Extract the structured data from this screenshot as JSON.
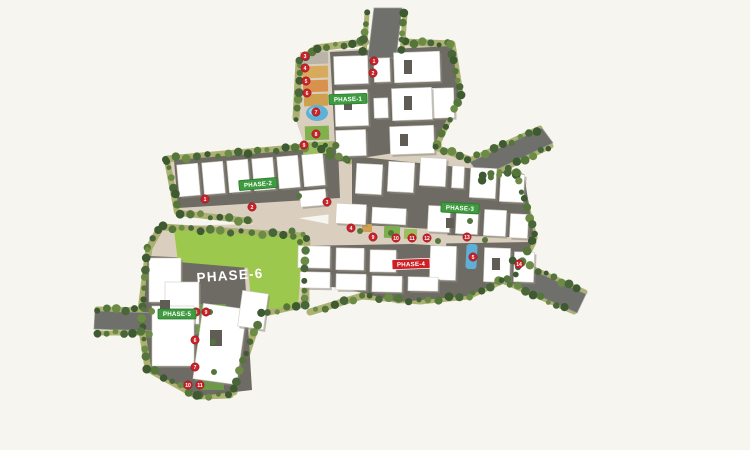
{
  "background": "#f7f5f0",
  "palette": {
    "ground": "#dacfbf",
    "pad": "#6e6b64",
    "road": "#6f6f6c",
    "road_edge": "#9b9b94",
    "verge": "#a9ae6c",
    "trees": [
      "#3d5a31",
      "#55763a",
      "#6c8c45",
      "#49663a"
    ],
    "building": "#ffffff",
    "building_shadow": "#8d897f",
    "building_stroke": "#cfcabf",
    "detail": "#5f5c55",
    "lawn_field": "#9cc84e",
    "pool": "#5fb0d8",
    "pool_light": "#9ad2e8",
    "marker": "#c8232b",
    "marker_stroke": "#8e1116",
    "marker_text": "#ffffff",
    "phase_green": "#3f9b3f",
    "phase_green_dark": "#2e7a2e",
    "phase_red": "#cf1f26",
    "label_text": "#ffffff"
  },
  "ground": [
    {
      "name": "phase1-ground",
      "pts": "300,52 452,44 461,96 434,150 352,168 314,172 295,118"
    },
    {
      "name": "phase2-ground",
      "pts": "166,158 344,142 348,212 284,220 268,248 252,222 178,212"
    },
    {
      "name": "center-ground",
      "pts": "268,212 348,228 344,256 264,244"
    },
    {
      "name": "phase3-ground",
      "pts": "338,148 432,144 478,160 522,172 536,240 522,274 468,298 398,304 344,288 328,232 330,176"
    },
    {
      "name": "phase56-ground",
      "pts": "158,226 262,224 268,210 292,208 300,226 308,226 310,302 262,316 232,396 196,398 150,372 140,318 148,246"
    }
  ],
  "pads": [
    {
      "name": "phase1-pad",
      "pts": "330,52 452,46 459,95 433,147 336,162"
    },
    {
      "name": "phase2-pad",
      "pts": "174,160 338,147 340,198 178,208"
    },
    {
      "name": "phase3-pad-upper",
      "pts": "352,156 524,174 534,238 352,232"
    },
    {
      "name": "phase3-pad-lower",
      "pts": "296,246 532,242 522,272 468,296 398,302 344,288 294,284"
    },
    {
      "name": "phase3-amenity-strip",
      "pts": "346,224 448,230 446,246 344,240",
      "fill": "#dacfbf"
    },
    {
      "name": "phase56-pad",
      "pts": "148,256 244,260 252,390 200,396 152,372 143,318"
    }
  ],
  "lawn_field": {
    "name": "phase6-field",
    "pts": "174,230 304,238 298,306 252,310 248,268 178,262"
  },
  "roads": [
    {
      "name": "road-north-entry",
      "pts": "374,8 402,8 396,58 368,58"
    },
    {
      "name": "road-northeast-exit",
      "pts": "470,162 542,128 553,143 481,177"
    },
    {
      "name": "road-southeast-exit",
      "pts": "510,260 586,294 577,313 501,279"
    },
    {
      "name": "road-west-entry",
      "pts": "95,311 157,313 156,331 94,329"
    }
  ],
  "tree_lines": [
    {
      "pts": [
        [
          296,
          118
        ],
        [
          299,
          62
        ],
        [
          314,
          50
        ]
      ],
      "spacing": 9,
      "band": 7
    },
    {
      "pts": [
        [
          316,
          48
        ],
        [
          366,
          42
        ]
      ],
      "spacing": 9,
      "band": 7
    },
    {
      "pts": [
        [
          404,
          42
        ],
        [
          452,
          44
        ],
        [
          460,
          94
        ],
        [
          436,
          146
        ]
      ],
      "spacing": 9,
      "band": 7
    },
    {
      "pts": [
        [
          367,
          14
        ],
        [
          364,
          54
        ]
      ],
      "spacing": 9,
      "band": 5
    },
    {
      "pts": [
        [
          405,
          14
        ],
        [
          402,
          54
        ]
      ],
      "spacing": 9,
      "band": 5
    },
    {
      "pts": [
        [
          167,
          159
        ],
        [
          340,
          144
        ]
      ],
      "spacing": 10,
      "band": 7
    },
    {
      "pts": [
        [
          167,
          160
        ],
        [
          177,
          212
        ]
      ],
      "spacing": 9,
      "band": 6
    },
    {
      "pts": [
        [
          179,
          213
        ],
        [
          250,
          221
        ]
      ],
      "spacing": 10,
      "band": 6
    },
    {
      "pts": [
        [
          434,
          147
        ],
        [
          472,
          160
        ]
      ],
      "spacing": 9,
      "band": 6
    },
    {
      "pts": [
        [
          482,
          177
        ],
        [
          518,
          173
        ],
        [
          534,
          238
        ]
      ],
      "spacing": 9,
      "band": 7
    },
    {
      "pts": [
        [
          533,
          242
        ],
        [
          517,
          274
        ],
        [
          468,
          296
        ],
        [
          420,
          301
        ],
        [
          362,
          296
        ],
        [
          310,
          312
        ]
      ],
      "spacing": 10,
      "band": 7
    },
    {
      "pts": [
        [
          470,
          160
        ],
        [
          540,
          128
        ]
      ],
      "spacing": 9,
      "band": 5
    },
    {
      "pts": [
        [
          483,
          179
        ],
        [
          551,
          146
        ]
      ],
      "spacing": 9,
      "band": 5
    },
    {
      "pts": [
        [
          512,
          259
        ],
        [
          585,
          292
        ]
      ],
      "spacing": 9,
      "band": 5
    },
    {
      "pts": [
        [
          500,
          280
        ],
        [
          574,
          312
        ]
      ],
      "spacing": 9,
      "band": 5
    },
    {
      "pts": [
        [
          162,
          227
        ],
        [
          302,
          236
        ]
      ],
      "spacing": 10,
      "band": 7
    },
    {
      "pts": [
        [
          307,
          240
        ],
        [
          305,
          304
        ],
        [
          260,
          314
        ],
        [
          234,
          392
        ]
      ],
      "spacing": 10,
      "band": 7
    },
    {
      "pts": [
        [
          230,
          395
        ],
        [
          197,
          396
        ],
        [
          152,
          371
        ]
      ],
      "spacing": 10,
      "band": 7
    },
    {
      "pts": [
        [
          148,
          368
        ],
        [
          140,
          318
        ],
        [
          149,
          248
        ],
        [
          159,
          230
        ]
      ],
      "spacing": 10,
      "band": 7
    },
    {
      "pts": [
        [
          97,
          309
        ],
        [
          155,
          310
        ]
      ],
      "spacing": 9,
      "band": 5
    },
    {
      "pts": [
        [
          96,
          333
        ],
        [
          154,
          333
        ]
      ],
      "spacing": 9,
      "band": 5
    },
    {
      "pts": [
        [
          320,
          150
        ],
        [
          350,
          162
        ]
      ],
      "spacing": 10,
      "band": 5
    }
  ],
  "single_trees": [
    [
      330,
      151,
      4
    ],
    [
      346,
      159,
      3.5
    ],
    [
      299,
      196,
      3
    ],
    [
      292,
      231,
      3.5
    ],
    [
      360,
      231,
      3
    ],
    [
      391,
      233,
      3
    ],
    [
      438,
      241,
      3
    ],
    [
      470,
      221,
      3
    ],
    [
      300,
      242,
      3
    ],
    [
      485,
      240,
      3
    ],
    [
      210,
      312,
      3
    ],
    [
      213,
      342,
      3
    ],
    [
      214,
      372,
      3
    ]
  ],
  "amenities": [
    {
      "type": "rect",
      "name": "amenity-court-1",
      "x": 302,
      "y": 52,
      "w": 26,
      "h": 12,
      "fill": "#b9b3a8",
      "rot": -2
    },
    {
      "type": "rect",
      "name": "amenity-court-2",
      "x": 302,
      "y": 66,
      "w": 26,
      "h": 12,
      "fill": "#d8aa5e",
      "rot": -2
    },
    {
      "type": "rect",
      "name": "amenity-court-3",
      "x": 303,
      "y": 80,
      "w": 25,
      "h": 12,
      "fill": "#d8924e",
      "rot": -2
    },
    {
      "type": "rect",
      "name": "amenity-court-4",
      "x": 304,
      "y": 94,
      "w": 24,
      "h": 12,
      "fill": "#cfa04f",
      "rot": -2
    },
    {
      "type": "pool",
      "name": "swimming-pool",
      "cx": 317,
      "cy": 113,
      "rx": 11,
      "ry": 8
    },
    {
      "type": "rect",
      "name": "amenity-court-5",
      "x": 305,
      "y": 126,
      "w": 24,
      "h": 14,
      "fill": "#83b04e",
      "rot": -2
    },
    {
      "type": "rect",
      "name": "amenity-court-6",
      "x": 303,
      "y": 142,
      "w": 26,
      "h": 12,
      "fill": "#9abf5c",
      "rot": -2
    },
    {
      "type": "poolrect",
      "name": "lap-pool",
      "x": 466,
      "y": 244,
      "w": 11,
      "h": 25,
      "rot": 3
    },
    {
      "type": "rect",
      "name": "amenity-court-7",
      "x": 384,
      "y": 226,
      "w": 16,
      "h": 12,
      "fill": "#7fae4e",
      "rot": 2
    },
    {
      "type": "rect",
      "name": "amenity-court-8",
      "x": 404,
      "y": 229,
      "w": 13,
      "h": 10,
      "fill": "#9abf5c",
      "rot": 2
    },
    {
      "type": "rect",
      "name": "amenity-court-9",
      "x": 362,
      "y": 224,
      "w": 10,
      "h": 8,
      "fill": "#cfa04f",
      "rot": 2
    },
    {
      "type": "rect",
      "name": "lawn-strip-1",
      "x": 196,
      "y": 304,
      "w": 30,
      "h": 30,
      "fill": "#6f994a",
      "rot": 0
    },
    {
      "type": "rect",
      "name": "lawn-strip-2",
      "x": 198,
      "y": 338,
      "w": 28,
      "h": 26,
      "fill": "#7fae4e",
      "rot": 0
    },
    {
      "type": "rect",
      "name": "lawn-strip-3",
      "x": 200,
      "y": 368,
      "w": 24,
      "h": 22,
      "fill": "#6f994a",
      "rot": 0
    }
  ],
  "buildings": [
    [
      334,
      56,
      34,
      28,
      -2
    ],
    [
      374,
      58,
      16,
      24,
      -2
    ],
    [
      394,
      52,
      46,
      30,
      -2
    ],
    [
      432,
      88,
      22,
      30,
      -2
    ],
    [
      335,
      90,
      33,
      36,
      -2
    ],
    [
      392,
      88,
      40,
      32,
      -2
    ],
    [
      336,
      130,
      30,
      26,
      -2
    ],
    [
      390,
      126,
      44,
      28,
      -2
    ],
    [
      374,
      98,
      14,
      20,
      -2
    ],
    [
      178,
      164,
      21,
      32,
      -5
    ],
    [
      203,
      162,
      21,
      32,
      -5
    ],
    [
      228,
      160,
      21,
      32,
      -5
    ],
    [
      253,
      158,
      21,
      32,
      -5
    ],
    [
      278,
      156,
      21,
      32,
      -5
    ],
    [
      303,
      154,
      21,
      32,
      -5
    ],
    [
      300,
      190,
      26,
      16,
      -5
    ],
    [
      356,
      164,
      26,
      30,
      3
    ],
    [
      388,
      162,
      26,
      30,
      3
    ],
    [
      420,
      158,
      26,
      28,
      3
    ],
    [
      452,
      166,
      12,
      22,
      3
    ],
    [
      470,
      168,
      26,
      30,
      3
    ],
    [
      500,
      174,
      24,
      28,
      3
    ],
    [
      428,
      206,
      22,
      26,
      3
    ],
    [
      456,
      208,
      22,
      26,
      3
    ],
    [
      484,
      210,
      22,
      26,
      3
    ],
    [
      510,
      214,
      18,
      24,
      3
    ],
    [
      336,
      204,
      30,
      20,
      3
    ],
    [
      372,
      208,
      34,
      16,
      3
    ],
    [
      298,
      246,
      32,
      22,
      1
    ],
    [
      336,
      248,
      28,
      22,
      1
    ],
    [
      370,
      250,
      26,
      22,
      1
    ],
    [
      430,
      246,
      26,
      34,
      2
    ],
    [
      484,
      248,
      26,
      34,
      2
    ],
    [
      514,
      252,
      20,
      30,
      2
    ],
    [
      300,
      272,
      30,
      16,
      1
    ],
    [
      336,
      274,
      30,
      16,
      1
    ],
    [
      372,
      276,
      30,
      16,
      1
    ],
    [
      408,
      277,
      30,
      14,
      1
    ],
    [
      149,
      258,
      32,
      44,
      0
    ],
    [
      165,
      282,
      34,
      42,
      0
    ],
    [
      152,
      306,
      42,
      60,
      0
    ],
    [
      198,
      306,
      44,
      76,
      8
    ],
    [
      240,
      292,
      26,
      36,
      8
    ]
  ],
  "building_details": [
    [
      404,
      60,
      8,
      14
    ],
    [
      404,
      96,
      8,
      14
    ],
    [
      344,
      98,
      8,
      12
    ],
    [
      400,
      134,
      8,
      12
    ],
    [
      160,
      300,
      10,
      14
    ],
    [
      210,
      330,
      12,
      16
    ],
    [
      446,
      218,
      8,
      10
    ],
    [
      492,
      258,
      8,
      12
    ]
  ],
  "markers": [
    {
      "n": "1",
      "x": 374,
      "y": 61
    },
    {
      "n": "2",
      "x": 373,
      "y": 73
    },
    {
      "n": "3",
      "x": 305,
      "y": 56
    },
    {
      "n": "4",
      "x": 305,
      "y": 68
    },
    {
      "n": "5",
      "x": 306,
      "y": 81
    },
    {
      "n": "6",
      "x": 307,
      "y": 93
    },
    {
      "n": "7",
      "x": 316,
      "y": 112
    },
    {
      "n": "8",
      "x": 316,
      "y": 134
    },
    {
      "n": "9",
      "x": 304,
      "y": 145
    },
    {
      "n": "1",
      "x": 205,
      "y": 199
    },
    {
      "n": "2",
      "x": 252,
      "y": 207
    },
    {
      "n": "3",
      "x": 327,
      "y": 202
    },
    {
      "n": "4",
      "x": 351,
      "y": 228
    },
    {
      "n": "9",
      "x": 373,
      "y": 237
    },
    {
      "n": "10",
      "x": 396,
      "y": 238
    },
    {
      "n": "11",
      "x": 412,
      "y": 238
    },
    {
      "n": "12",
      "x": 427,
      "y": 238
    },
    {
      "n": "13",
      "x": 467,
      "y": 237
    },
    {
      "n": "5",
      "x": 473,
      "y": 257
    },
    {
      "n": "14",
      "x": 519,
      "y": 264
    },
    {
      "n": "8",
      "x": 196,
      "y": 312
    },
    {
      "n": "9",
      "x": 206,
      "y": 312
    },
    {
      "n": "6",
      "x": 195,
      "y": 340
    },
    {
      "n": "7",
      "x": 195,
      "y": 367
    },
    {
      "n": "10",
      "x": 188,
      "y": 385
    },
    {
      "n": "11",
      "x": 200,
      "y": 385
    }
  ],
  "labels": [
    {
      "text": "PHASE-1",
      "x": 348,
      "y": 99,
      "rot": -2,
      "style": "green"
    },
    {
      "text": "PHASE-2",
      "x": 258,
      "y": 184,
      "rot": -5,
      "style": "green"
    },
    {
      "text": "PHASE-3",
      "x": 460,
      "y": 208,
      "rot": 3,
      "style": "green"
    },
    {
      "text": "PHASE-4",
      "x": 411,
      "y": 264,
      "rot": -2,
      "style": "red"
    },
    {
      "text": "PHASE-5",
      "x": 177,
      "y": 314,
      "rot": 0,
      "style": "green"
    },
    {
      "text": "PHASE-6",
      "x": 230,
      "y": 276,
      "rot": -4,
      "style": "field"
    }
  ]
}
